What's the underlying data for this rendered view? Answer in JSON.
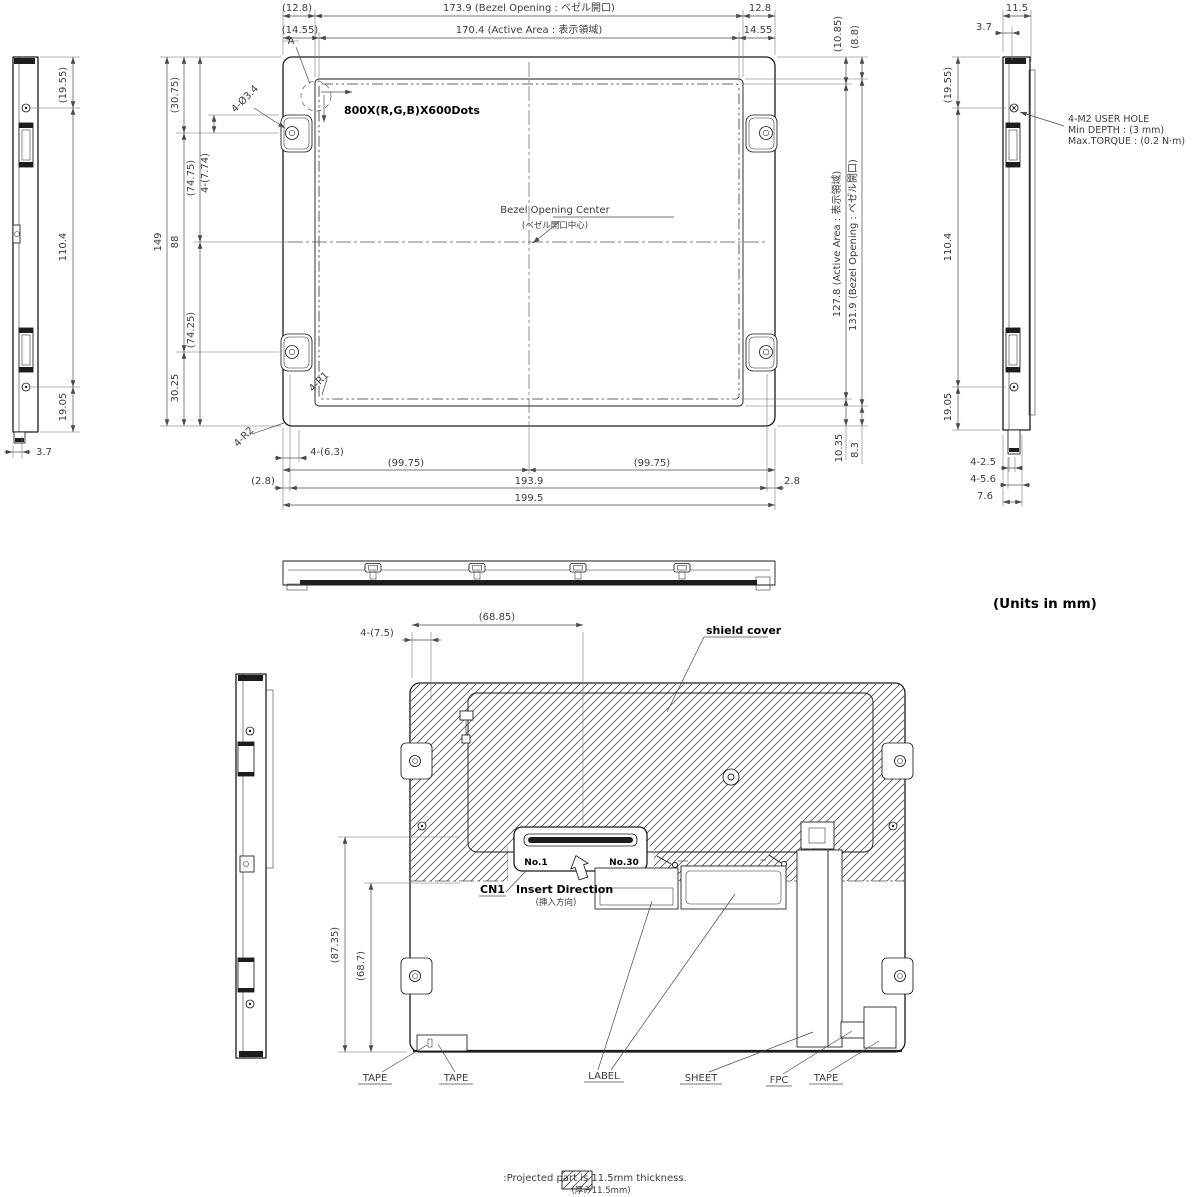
{
  "units_note": "(Units in mm)",
  "footer_note": {
    "line1": ":Projected part is 11.5mm thickness.",
    "line2": "(厚み11.5mm)"
  },
  "front": {
    "detail_a": "A",
    "dots": "800X(R,G,B)X600Dots",
    "bezel_center_en": "Bezel Opening Center",
    "bezel_center_jp": "(ベゼル開口中心)",
    "d_12_8_ref": "(12.8)",
    "d_bezel_w": "173.9  (Bezel Opening : ベゼル開口)",
    "d_12_8": "12.8",
    "d_14_55_ref": "(14.55)",
    "d_active_w": "170.4  (Active Area : 表示領域)",
    "d_14_55": "14.55",
    "d_10_85_ref": "(10.85)",
    "d_8_8_ref": "(8.8)",
    "d_149": "149",
    "d_30_75_ref": "(30.75)",
    "d_88": "88",
    "d_30_25": "30.25",
    "d_74_75_ref": "(74.75)",
    "d_74_25_ref": "(74.25)",
    "d_7_74": "4-(7.74)",
    "hole": "4-Ø3.4",
    "r1": "4-R1",
    "r2": "4-R2",
    "d_6_3": "4-(6.3)",
    "d_99_75_ref": "(99.75)",
    "d_193_9": "193.9",
    "d_2_8_ref": "(2.8)",
    "d_2_8": "2.8",
    "d_199_5": "199.5",
    "d_10_35": "10.35",
    "d_8_3": "8.3",
    "d_active_h": "127.8  (Active Area : 表示領域)",
    "d_bezel_h": "131.9  (Bezel Opening : ベゼル開口)"
  },
  "side_left": {
    "d_19_55_ref": "(19.55)",
    "d_110_4": "110.4",
    "d_19_05": "19.05",
    "d_3_7": "3.7"
  },
  "side_right": {
    "d_11_5": "11.5",
    "d_3_7": "3.7",
    "d_19_55_ref": "(19.55)",
    "d_110_4": "110.4",
    "d_19_05": "19.05",
    "note1": "4-M2 USER HOLE",
    "note2": "Min DEPTH : (3 mm)",
    "note3": "Max.TORQUE : (0.2 N·m)",
    "d_2_5": "4-2.5",
    "d_5_6": "4-5.6",
    "d_7_6": "7.6"
  },
  "rear": {
    "d_7_5": "4-(7.5)",
    "d_68_85_ref": "(68.85)",
    "shield": "shield cover",
    "pin1": "No.1",
    "pin30": "No.30",
    "cn1": "CN1",
    "insert_en": "Insert Direction",
    "insert_jp": "(挿入方向)",
    "d_87_35_ref": "(87.35)",
    "d_68_7_ref": "(68.7)",
    "tape": "TAPE",
    "label": "LABEL",
    "sheet": "SHEET",
    "fpc": "FPC"
  }
}
